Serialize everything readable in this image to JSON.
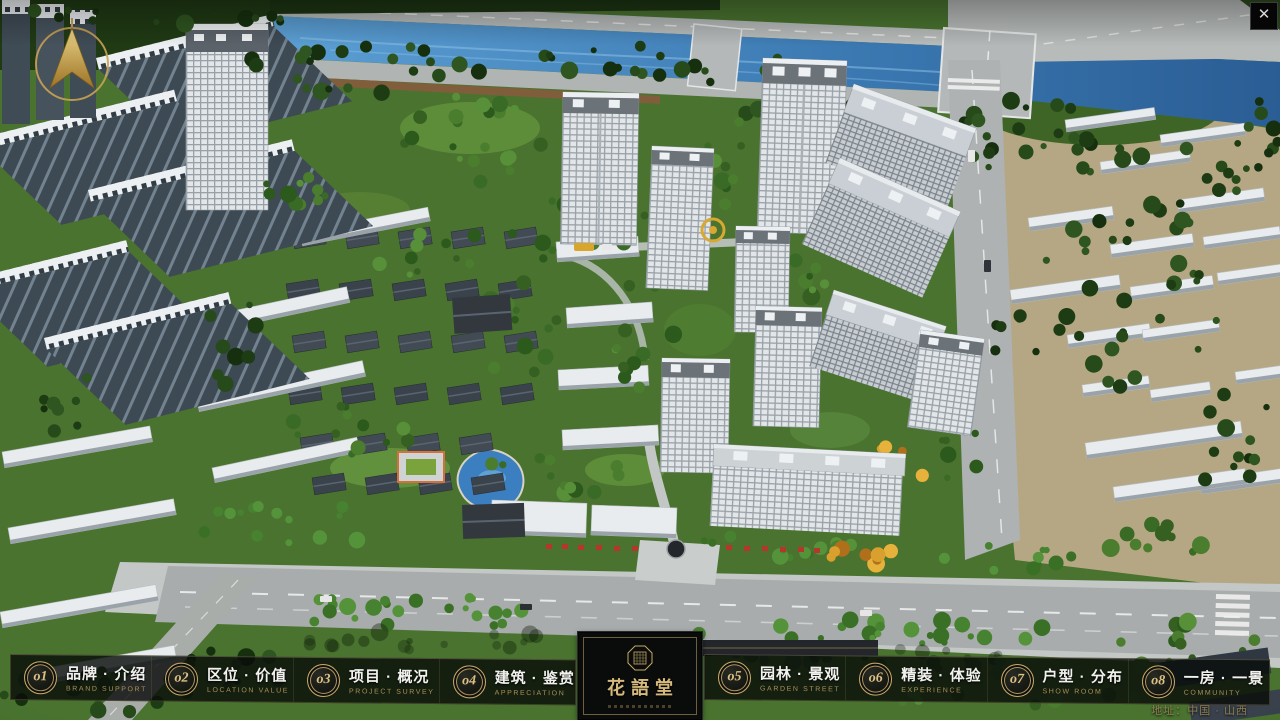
{
  "window": {
    "close_glyph": "✕"
  },
  "menu": {
    "items": [
      {
        "num": "o1",
        "zh": "品牌 · 介绍",
        "en": "BRAND SUPPORT"
      },
      {
        "num": "o2",
        "zh": "区位 · 价值",
        "en": "LOCATION VALUE"
      },
      {
        "num": "o3",
        "zh": "项目 · 概况",
        "en": "PROJECT SURVEY"
      },
      {
        "num": "o4",
        "zh": "建筑 · 鉴赏",
        "en": "APPRECIATION"
      },
      {
        "num": "o5",
        "zh": "园林 · 景观",
        "en": "GARDEN STREET"
      },
      {
        "num": "o6",
        "zh": "精装 · 体验",
        "en": "EXPERIENCE"
      },
      {
        "num": "o7",
        "zh": "户型 · 分布",
        "en": "SHOW ROOM"
      },
      {
        "num": "o8",
        "zh": "一房 · 一景",
        "en": "COMMUNITY"
      }
    ]
  },
  "logo": {
    "title": "花語堂"
  },
  "footer": {
    "address": "地址：中国 · 山西"
  },
  "colors": {
    "accent_gold": "#c9a96a",
    "bar_background": "#0b0e0c",
    "menu_text": "#f1f1ee",
    "menu_text_secondary": "#ab9158",
    "water": "#3c7fc0"
  }
}
